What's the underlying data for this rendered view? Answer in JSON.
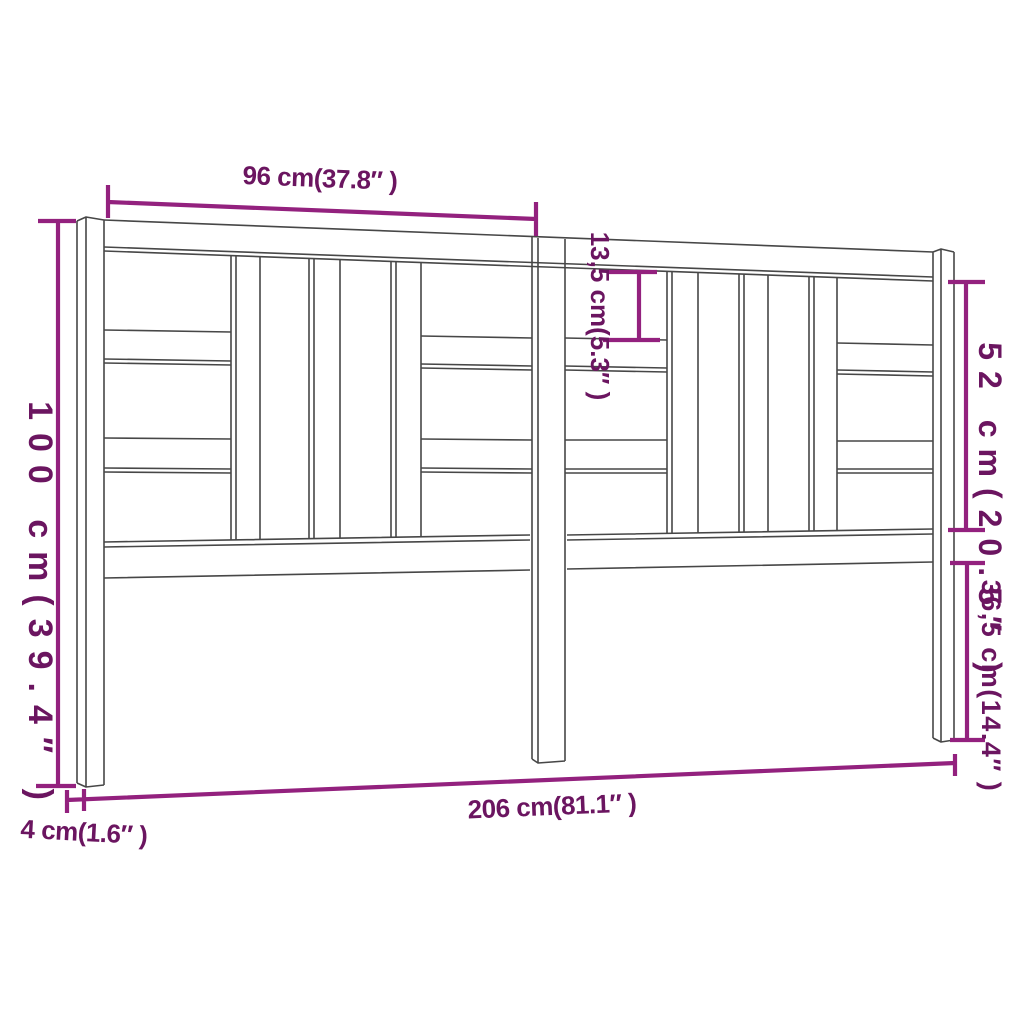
{
  "diagram": {
    "kind": "furniture-dimension-diagram",
    "subject": "headboard"
  },
  "dimensions": {
    "top_section_width": "96 cm(37.8″ )",
    "top_gap_height": "13,5 cm(5.3″ )",
    "inner_panel_height": "52 cm(20.5″ )",
    "total_height": "100 cm(39.4″ )",
    "leg_section_height": "36,5 cm(14.4″ )",
    "total_width": "206 cm(81.1″ )",
    "thickness": "4 cm(1.6″ )"
  },
  "colors": {
    "background": "#FFFFFF",
    "drawing_line": "#474747",
    "dimension_line": "#93217E",
    "dimension_text": "#6B1560"
  }
}
